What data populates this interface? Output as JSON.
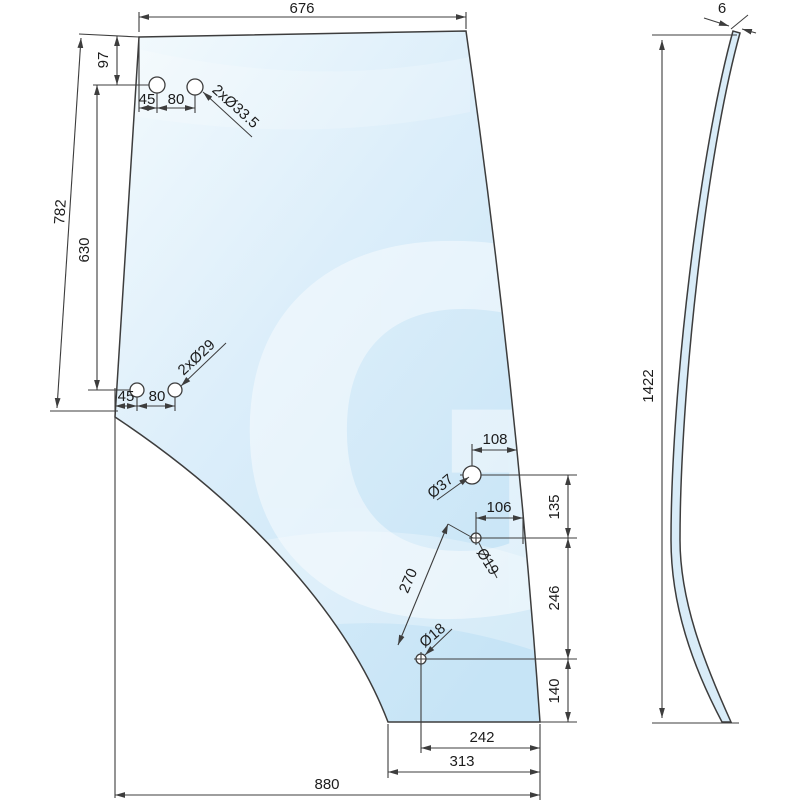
{
  "colors": {
    "line": "#3d3d3d",
    "text": "#1c1c1c",
    "background": "#ffffff",
    "glass-top": "#f3fafd",
    "glass-mid": "#dceefa",
    "glass-deep": "#c6e4f6",
    "glass-side": "#d9ecf8",
    "watermark": "#ffffff"
  },
  "labels": {
    "top_width": "676",
    "left_slant_height": "782",
    "top_corner_offset": "97",
    "left_hole_span": "630",
    "upper_holes_dia": "2xØ33.5",
    "upper_holes_offset_1": "45",
    "upper_holes_offset_2": "80",
    "lower_holes_dia": "2xØ29",
    "lower_holes_offset_1": "45",
    "lower_holes_offset_2": "80",
    "handle_hole_dia": "Ø37",
    "handle_hole_edge_offset": "108",
    "lock_hole_dia": "Ø19",
    "lock_hole_edge_offset": "106",
    "right_seg_upper": "135",
    "right_seg_middle": "246",
    "right_seg_lower": "140",
    "holes_distance": "270",
    "hinge_hole_dia": "Ø18",
    "bottom_offset_inner": "242",
    "bottom_offset_outer": "313",
    "bottom_width": "880",
    "glass_thickness": "6",
    "side_height": "1422",
    "watermark": "G"
  }
}
